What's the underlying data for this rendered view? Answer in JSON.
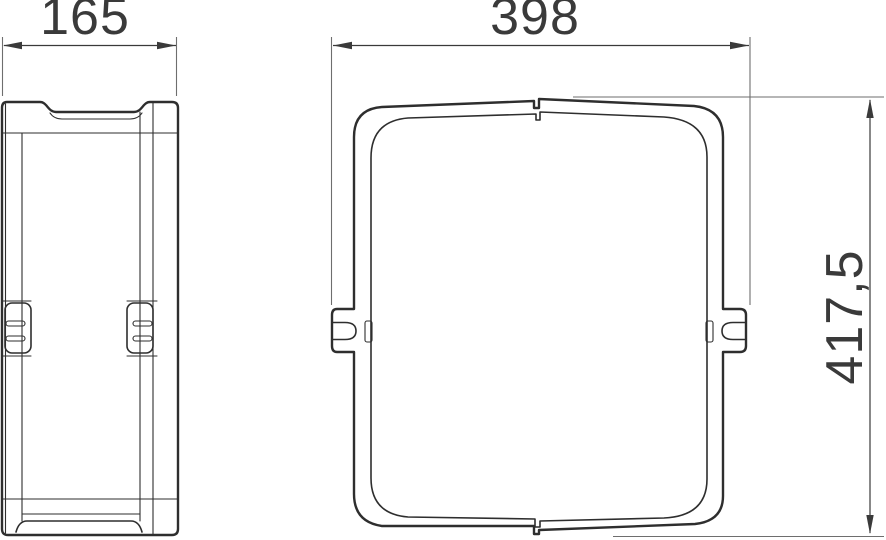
{
  "drawing": {
    "type": "technical-dimension-drawing",
    "views": {
      "side": {
        "name": "side-view"
      },
      "front": {
        "name": "front-view"
      }
    },
    "dimensions": {
      "depth_label": "165",
      "width_label": "398",
      "height_label": "417,5"
    },
    "colors": {
      "line": "#2e2e2e",
      "dimension": "#3a3a3a",
      "thin_line": "#6e6e6e",
      "background": "#ffffff",
      "text": "#3a3a3a"
    }
  }
}
